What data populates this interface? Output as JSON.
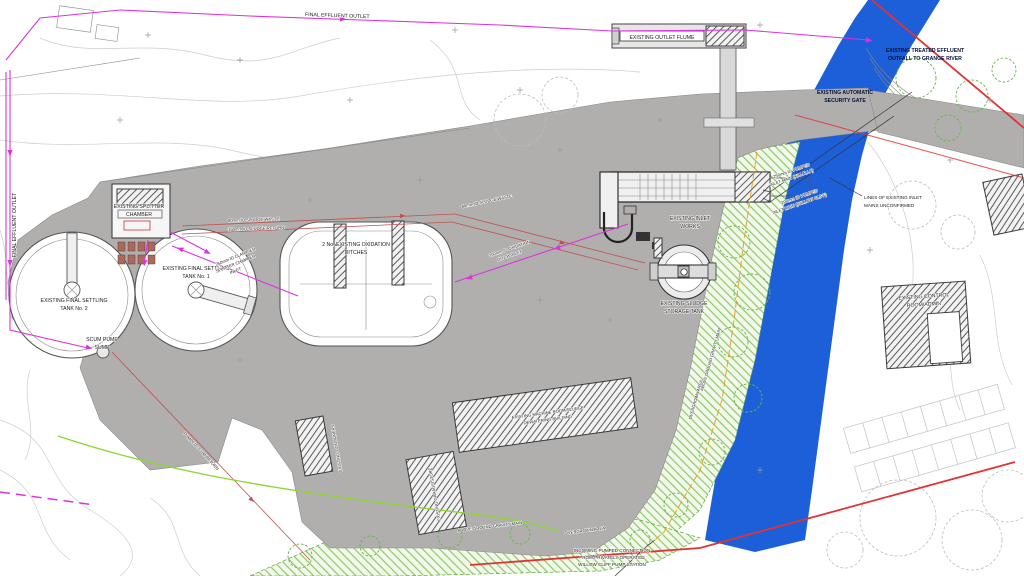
{
  "drawing": {
    "labels": {
      "final_effluent_outlet_top": "FINAL EFFLUENT OUTLET",
      "final_effluent_outlet_left": "FINAL EFFLUENT OUTLET",
      "outlet_flume": "EXISTING OUTLET FLUME",
      "treated_effluent_outfall": [
        "EXISTING TREATED EFFLUENT",
        "OUTFALL TO GRANGE RIVER"
      ],
      "security_gate": [
        "EXISTING AUTOMATIC",
        "SECURITY GATE"
      ],
      "settling_tank_1": [
        "EXISTING FINAL SETTLING",
        "TANK No. 1"
      ],
      "settling_tank_2": [
        "EXISTING FINAL SETTLING",
        "TANK No. 2"
      ],
      "splitter_chamber": [
        "EXISTING SPLITTER",
        "CHAMBER"
      ],
      "oxidation_ditches": [
        "2 No. EXISTING OXIDATION",
        "DITCHES"
      ],
      "sludge_waste": "80mm ID SLUDGE WASTE",
      "sludge_return": "150mm ID SLUDGE RETURN",
      "sludge_waste_2": "80mm ID SLUDGE WASTE",
      "ditch_inlet": [
        "200mm ID OXIDATION",
        "DITCH INLET"
      ],
      "splitter_inlet": [
        "250mm ID CLARIFIER",
        "SPLITTER CHAMBER",
        "INLET"
      ],
      "inlet_works": [
        "EXISTING INLET",
        "WORKS"
      ],
      "sludge_storage_tank": [
        "EXISTING SLUDGE",
        "STORAGE TANK"
      ],
      "inlet_main_250": [
        "250mm ID PUMPED",
        "INLET MAIN (KILLALLA)"
      ],
      "inlet_main_200": [
        "200mm ID PUMPED",
        "INLET MAIN (WILLOW CLIFF)"
      ],
      "mains_unconfirmed": [
        "LINES OF EXISTING INLET",
        "MAINS UNCONFIRMED"
      ],
      "control_room": [
        "EXISTING CONTROL",
        "ROOM/ADMIN"
      ],
      "machine_room": [
        "EXISTING MACHINE ROOM/SLUDGE",
        "DEWATERING BUILDING"
      ],
      "garage": "EXISTING GARAGE/STORE",
      "containers": "EXISTING CONTAINERS",
      "scum_pump_sump": [
        "SCUM PUMP",
        "SUMP"
      ],
      "pumped_scum_return": "PUMPED SCUM RETURN",
      "incoming_connection": [
        "INCOMING PUMPED CONNECTION",
        "FROM PRIVATELY OPERATED",
        "WILLOW CLIFF PUMP STATION"
      ],
      "overgrown_area": "OVERGROWN AREA",
      "above_ground_main": "ABOVE GROUND GRAVITY MAIN"
    },
    "colors": {
      "river": "#1d5fd8",
      "compound": "#b0afae",
      "boundary": "#e03434",
      "effluent_line": "#dd33dd",
      "utility_line": "#c0504d",
      "vegetation_hatch": "#86c55e",
      "lime_line": "#8cd62e",
      "orange_line": "#e8a32a"
    }
  }
}
